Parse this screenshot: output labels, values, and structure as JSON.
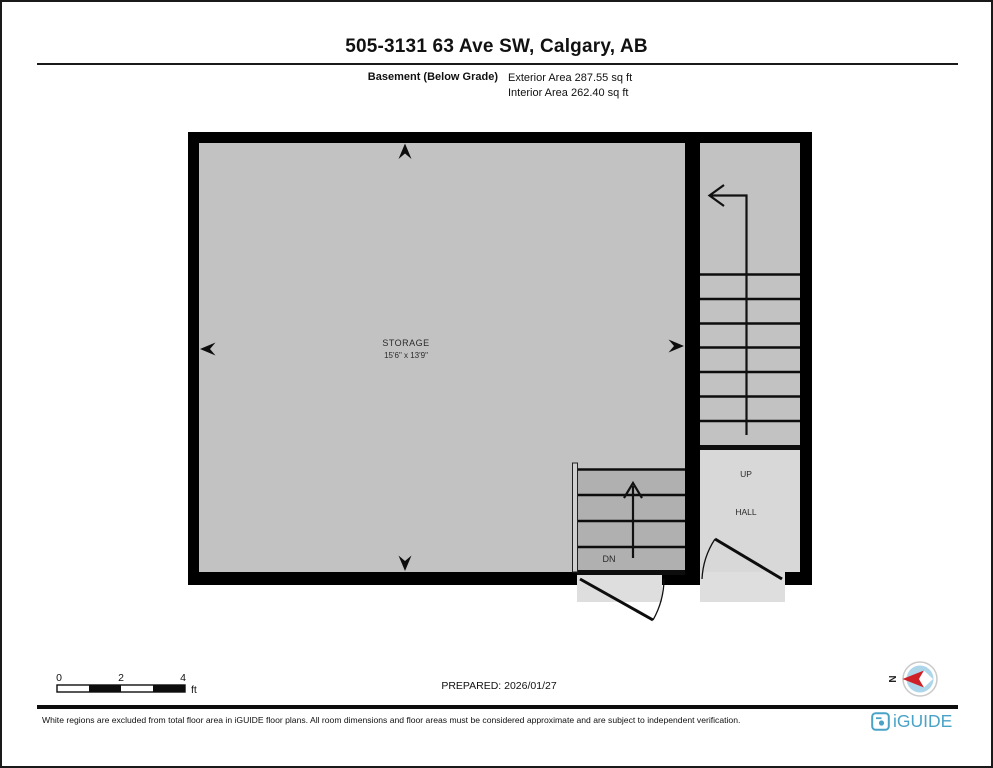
{
  "header": {
    "title": "505-3131 63 Ave SW, Calgary, AB",
    "floor_label": "Basement (Below Grade)",
    "exterior_area": "Exterior Area 287.55 sq ft",
    "interior_area": "Interior Area 262.40 sq ft"
  },
  "plan": {
    "storage": {
      "name": "STORAGE",
      "dimensions": "15'6\" x 13'9\""
    },
    "hall": {
      "up_label": "UP",
      "name": "HALL"
    },
    "stairs_down_label": "DN"
  },
  "scale_bar": {
    "ticks": [
      "0",
      "2",
      "4"
    ],
    "unit": "ft"
  },
  "prepared_label": "PREPARED: 2026/01/27",
  "compass": {
    "north_label": "N"
  },
  "footer": {
    "disclaimer": "White regions are excluded from total floor area in iGUIDE floor plans. All room dimensions and floor areas must be considered approximate and are subject to independent verification.",
    "brand": "iGUIDE"
  },
  "colors": {
    "wall": "#000000",
    "room_fill": "#c2c2c2",
    "stairs_down_fill": "#b0b0b0",
    "hall_fill": "#d8d8d8",
    "threshold_fill": "#dedede",
    "brand_blue": "#4aa3c7",
    "compass_blue": "#aed6ea",
    "compass_red": "#cf2027"
  }
}
